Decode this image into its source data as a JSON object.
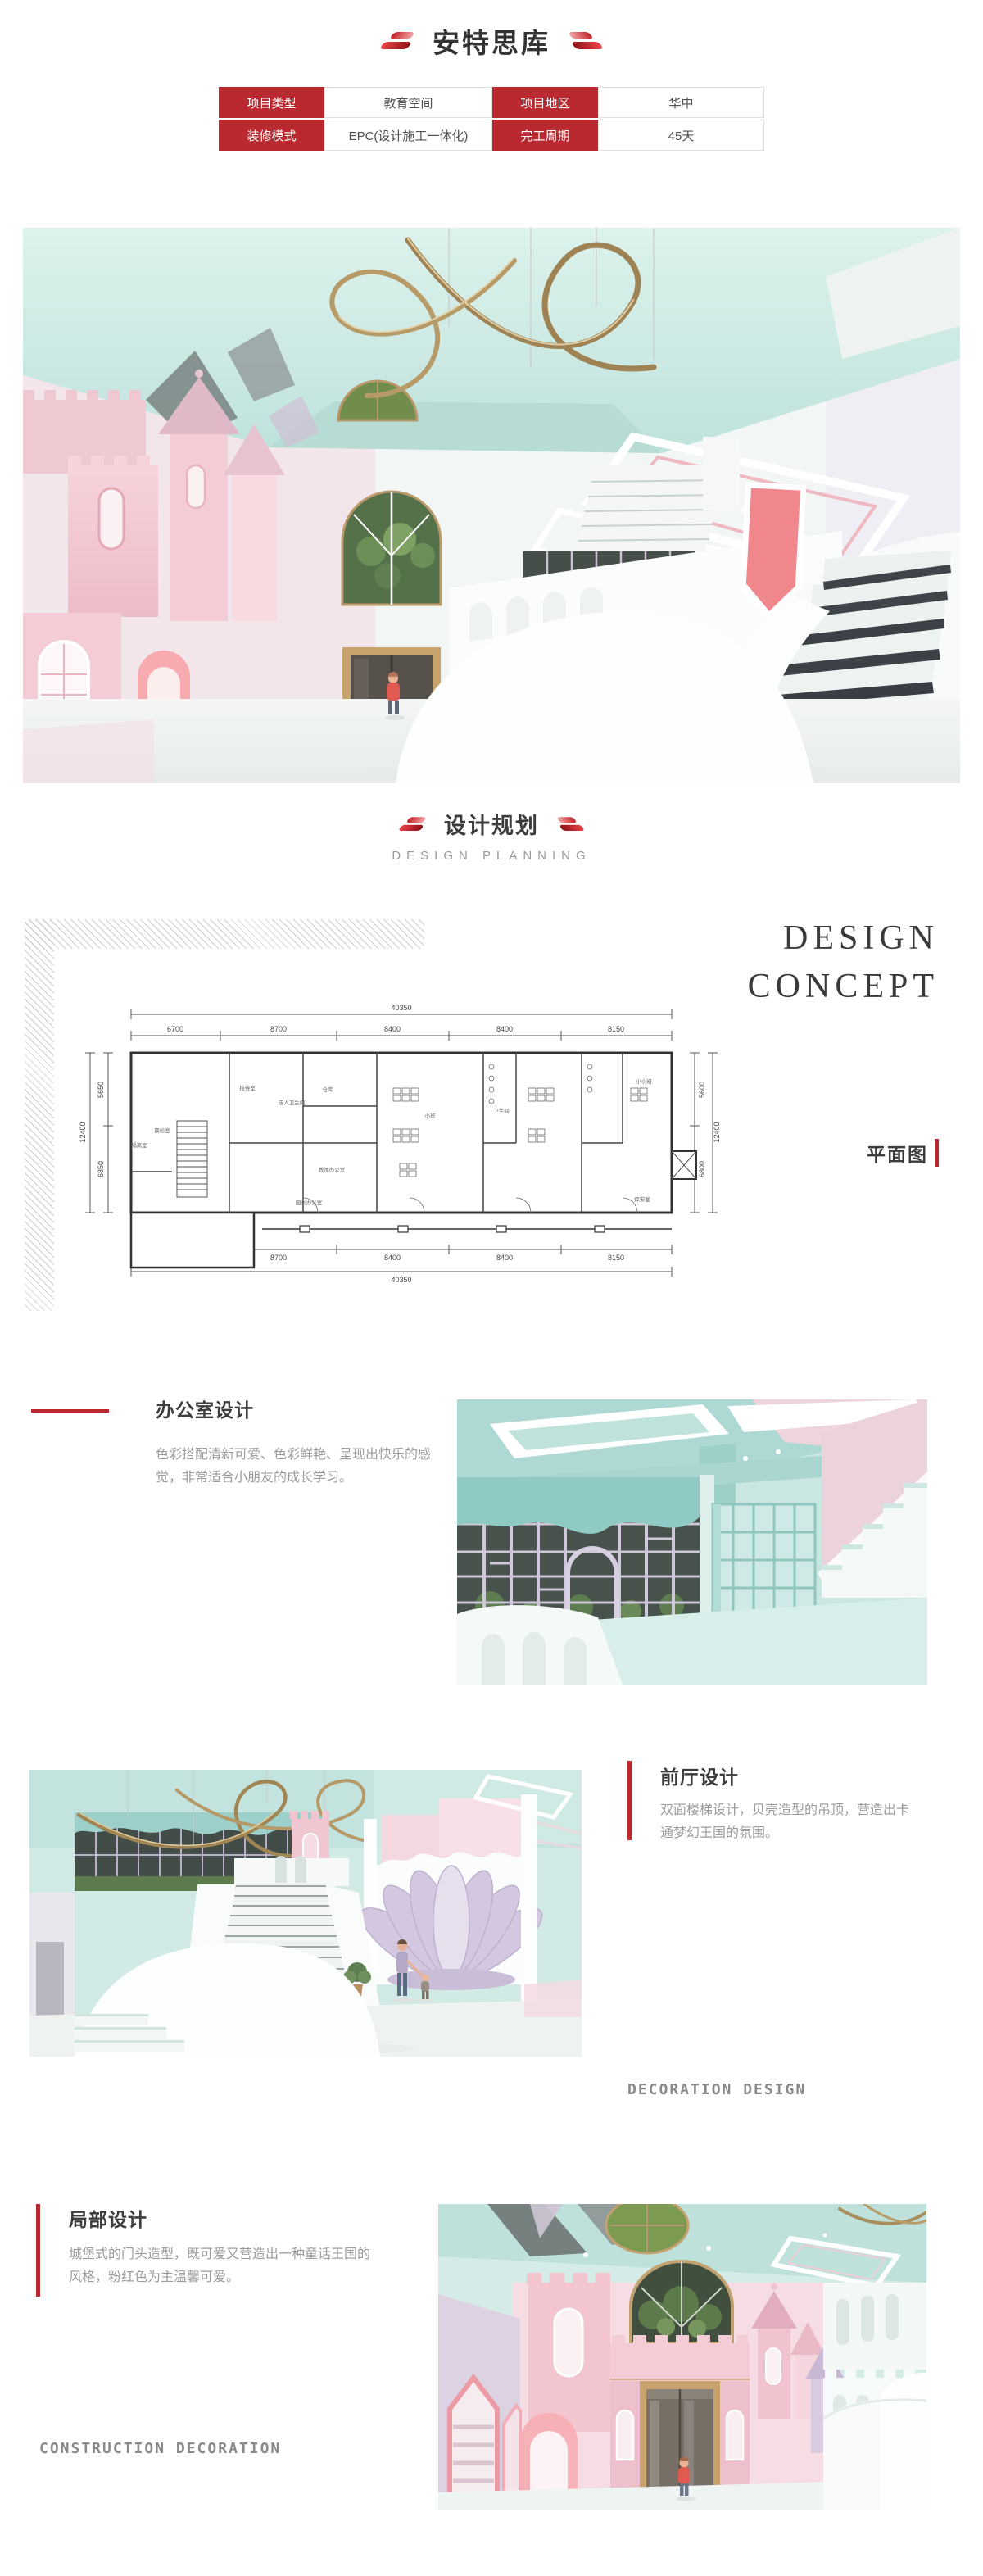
{
  "accent": {
    "red": "#b9292f"
  },
  "header": {
    "title": "安特思库"
  },
  "info_table": {
    "r0c0": "项目类型",
    "r0c1": "教育空间",
    "r0c2": "项目地区",
    "r0c3": "华中",
    "r1c0": "装修模式",
    "r1c1": "EPC(设计施工一体化)",
    "r1c2": "完工周期",
    "r1c3": "45天"
  },
  "planning_header": {
    "title": "设计规划",
    "subtitle": "DESIGN PLANNING"
  },
  "concept": {
    "line1": "DESIGN",
    "line2": "CONCEPT",
    "plan_tag": "平面图"
  },
  "floor_plan": {
    "total_top": "40350",
    "total_bottom": "40350",
    "top_segments": [
      "6700",
      "8700",
      "8400",
      "8400",
      "8150"
    ],
    "bottom_segments": [
      "6700",
      "8700",
      "8400",
      "8400",
      "8150"
    ],
    "left_segments": [
      "5650",
      "6850"
    ],
    "left_total": "12400",
    "right_segments": [
      "5600",
      "6800"
    ],
    "right_total": "12400",
    "rooms": [
      "晨检室",
      "隔离室",
      "接待室",
      "成人卫生间",
      "仓库",
      "教师办公室",
      "园长办公室",
      "小班",
      "卫生间",
      "小小班",
      "保安室"
    ]
  },
  "office_section": {
    "title": "办公室设计",
    "body": "色彩搭配清新可爱、色彩鲜艳、呈现出快乐的感觉，非常适合小朋友的成长学习。"
  },
  "lobby_section": {
    "title": "前厅设计",
    "body": "双面楼梯设计，贝壳造型的吊顶，营造出卡通梦幻王国的氛围。",
    "caption": "DECORATION DESIGN"
  },
  "detail_section": {
    "title": "局部设计",
    "body": "城堡式的门头造型，既可爱又营造出一种童话王国的风格，粉红色为主温馨可爱。",
    "caption": "CONSTRUCTION DECORATION"
  }
}
